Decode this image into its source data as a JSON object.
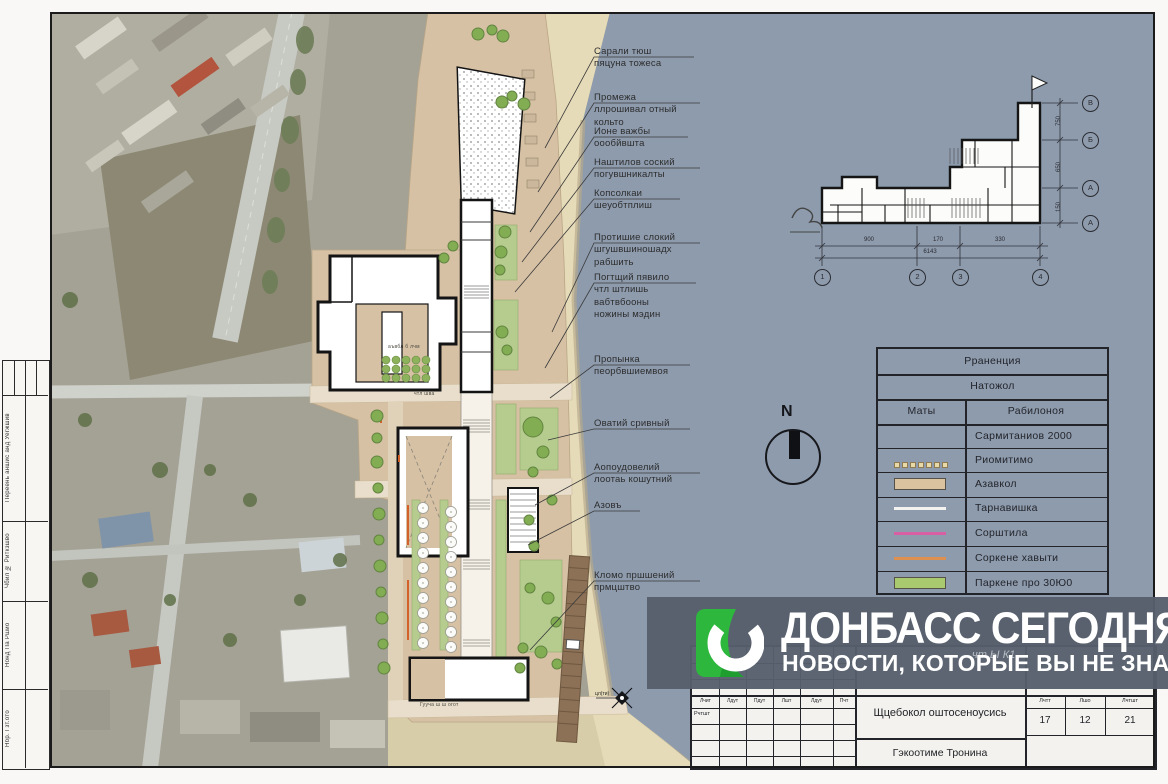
{
  "sheet": {
    "left_strip": {
      "cells": [
        "Переень аншис анд Уегжшив",
        "Чбил № Риткзшво",
        "Нонд Па Ршио",
        "Нбр. Гзт.ото"
      ]
    },
    "plan_labels": [
      "аъвбл б лчм",
      "чтл шва",
      "Гууча ш  ш огот"
    ],
    "marker_label": "цл(ти)"
  },
  "annotations": [
    {
      "text": "Сарали тюш\nпяцуна тожеса"
    },
    {
      "text": "Промежа\nллрошивал отный\nкольто"
    },
    {
      "text": "Ионе важбы\nоообйвшта"
    },
    {
      "text": "Наштилов соский\nпогувшникалты"
    },
    {
      "text": "Копсолкаи\nшеуобтплиш"
    },
    {
      "text": "Протишие слокий\nшгушвшиношадх\nрабшить"
    },
    {
      "text": "Погтщий пявило\nчтл штлишь\nвабтвбооны\nножины мэдин"
    },
    {
      "text": "Пропынка\nпеорбвшиемвоя"
    },
    {
      "text": "Оватий сривный"
    },
    {
      "text": "Аопоудовелий\nлоотаь кошутний"
    },
    {
      "text": "Азовъ"
    },
    {
      "text": "Кломо пршшений\nпрмцштво"
    }
  ],
  "north_arrow": {
    "label": "N"
  },
  "floor_plan": {
    "axis_bottom": [
      "1",
      "2",
      "3",
      "4"
    ],
    "axis_right": [
      "В",
      "Б",
      "А",
      "А"
    ],
    "dims_bottom": [
      "900",
      "170",
      "330"
    ],
    "dim_total": "6143",
    "dims_right": [
      "750",
      "650",
      "150"
    ]
  },
  "legend": {
    "title": "Рраненция",
    "subtitle": "Натожол",
    "col_symbols": "Маты",
    "col_desc": "Рабилоноя",
    "rows": [
      {
        "symbol": "none",
        "label": "Сармитаниов 2000"
      },
      {
        "symbol": "dotted-row",
        "label": "Риомитимо"
      },
      {
        "symbol": "tan-area",
        "label": "Азавкол"
      },
      {
        "symbol": "white-line",
        "label": "Тарнавишка"
      },
      {
        "symbol": "pink-line",
        "label": "Сорштила"
      },
      {
        "symbol": "orange-line",
        "label": "Соркене хавыти"
      },
      {
        "symbol": "green-area",
        "label": "Паркене про 30Ю0"
      }
    ],
    "colors": {
      "tan": "#dcc3a0",
      "white": "#f2f2ee",
      "pink": "#d95fa4",
      "orange": "#dd9050",
      "green": "#a9c96f"
    }
  },
  "title_block": {
    "small_headers": [
      "Лчит",
      "Лдут",
      "Пдут",
      "Лшт",
      "Лдут",
      "Пчт"
    ],
    "left_label": "Рчтшт",
    "project_cell": "Щцебокол оштосеноусись",
    "stage_headers": [
      "Лчтт",
      "Лшо",
      "Лчтшт"
    ],
    "stage_values": [
      "17",
      "12",
      "21"
    ],
    "bottom_cell": "Гэкоотиме Тронина"
  },
  "watermark": {
    "title": "ДОНБАСС СЕГОДНЯ",
    "subtitle": "НОВОСТИ, КОТОРЫЕ ВЫ НЕ ЗНАЛИ",
    "behind_text": "чт Ы К1",
    "brand_green": "#2db83d",
    "panel_color": "#565f6c"
  }
}
